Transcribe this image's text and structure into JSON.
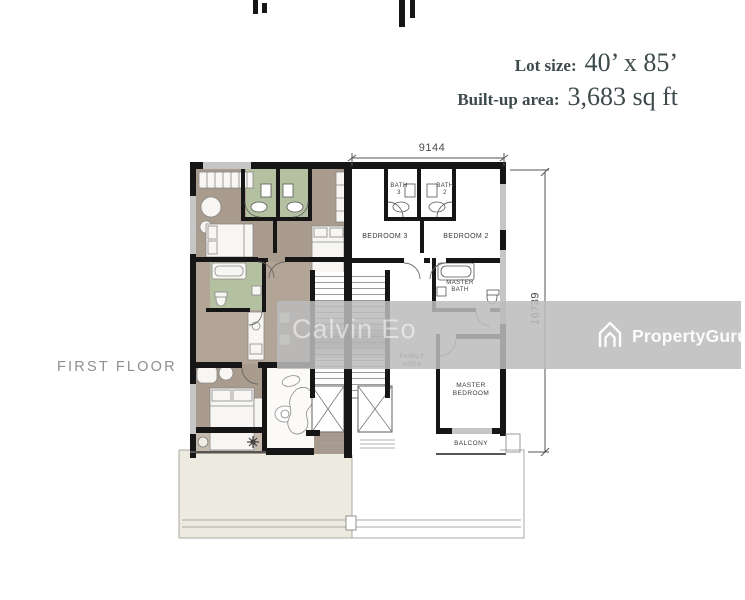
{
  "header": {
    "lot_label": "Lot size:",
    "lot_value": "40’ x 85’",
    "builtup_label": "Built-up area:",
    "builtup_value": "3,683 sq ft"
  },
  "floor_label": "FIRST FLOOR",
  "dims": {
    "width": "9144",
    "height": "16739"
  },
  "rooms": {
    "bath3": "BATH",
    "bath3_num": "3",
    "bath2": "BATH",
    "bath2_num": "2",
    "bedroom3": "BEDROOM 3",
    "bedroom2": "BEDROOM 2",
    "master_bath": "MASTER BATH",
    "family_area": "FAMILY AREA",
    "master_bedroom": "MASTER BEDROOM",
    "balcony": "BALCONY"
  },
  "watermark": {
    "author": "Calvin Eo",
    "brand": "PropertyGuru"
  },
  "colors": {
    "title_text": "#3d4a4b",
    "floor_label_text": "#8f8f8f",
    "watermark_band": "#c3c3c3",
    "left_unit_floor": "#a99b8d",
    "bath_floor": "#b3c1a0",
    "balcony_floor": "#c7bbae",
    "terrace_fill": "#edebdf",
    "wall": "#161616"
  }
}
